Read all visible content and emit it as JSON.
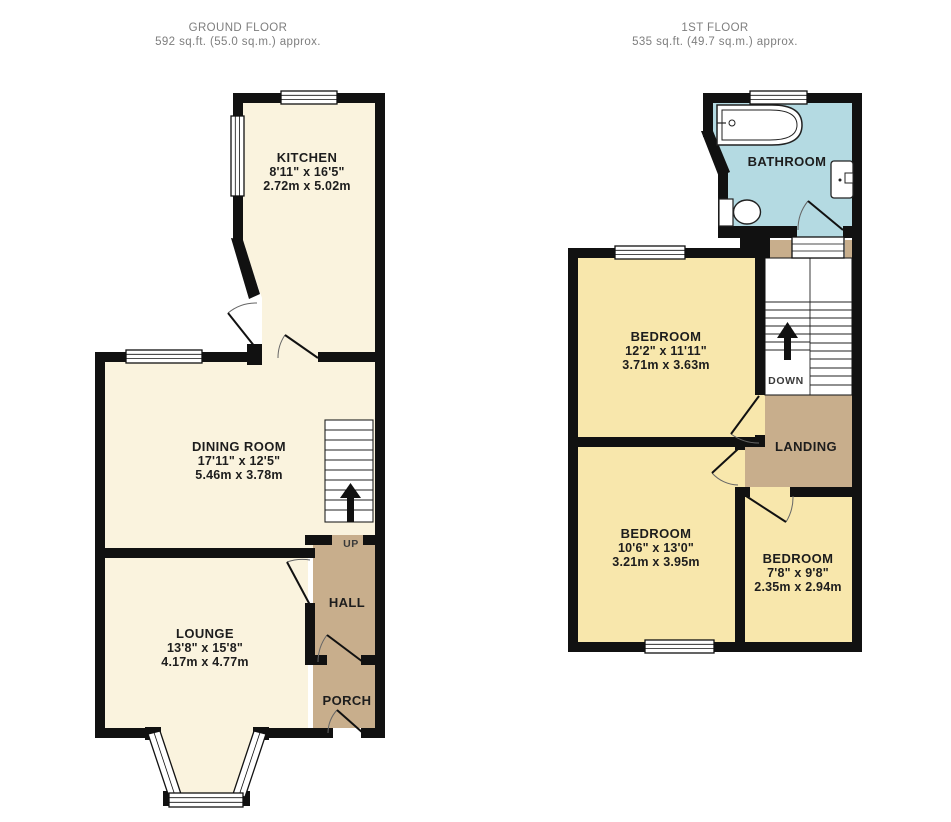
{
  "ground_floor": {
    "title": "GROUND FLOOR",
    "subtitle": "592 sq.ft. (55.0 sq.m.) approx.",
    "rooms": {
      "kitchen": {
        "name": "KITCHEN",
        "size_imperial": "8'11\" x 16'5\"",
        "size_metric": "2.72m x 5.02m"
      },
      "dining_room": {
        "name": "DINING ROOM",
        "size_imperial": "17'11\" x 12'5\"",
        "size_metric": "5.46m x 3.78m"
      },
      "lounge": {
        "name": "LOUNGE",
        "size_imperial": "13'8\" x 15'8\"",
        "size_metric": "4.17m x 4.77m"
      },
      "hall": {
        "name": "HALL"
      },
      "porch": {
        "name": "PORCH"
      }
    },
    "stairs_label": "UP"
  },
  "first_floor": {
    "title": "1ST FLOOR",
    "subtitle": "535 sq.ft. (49.7 sq.m.) approx.",
    "rooms": {
      "bathroom": {
        "name": "BATHROOM"
      },
      "bedroom_1": {
        "name": "BEDROOM",
        "size_imperial": "12'2\" x 11'11\"",
        "size_metric": "3.71m x 3.63m"
      },
      "bedroom_2": {
        "name": "BEDROOM",
        "size_imperial": "10'6\" x 13'0\"",
        "size_metric": "3.21m x 3.95m"
      },
      "bedroom_3": {
        "name": "BEDROOM",
        "size_imperial": "7'8\" x 9'8\"",
        "size_metric": "2.35m x 2.94m"
      },
      "landing": {
        "name": "LANDING"
      }
    },
    "stairs_label": "DOWN"
  },
  "colors": {
    "room_cream": "#FAF3DE",
    "room_yellow": "#F8E7AC",
    "room_brown": "#C8AE8C",
    "room_blue": "#B4DAE2",
    "wall": "#111111",
    "title_text": "#7E7E7E",
    "label_text": "#1D1D1D"
  }
}
